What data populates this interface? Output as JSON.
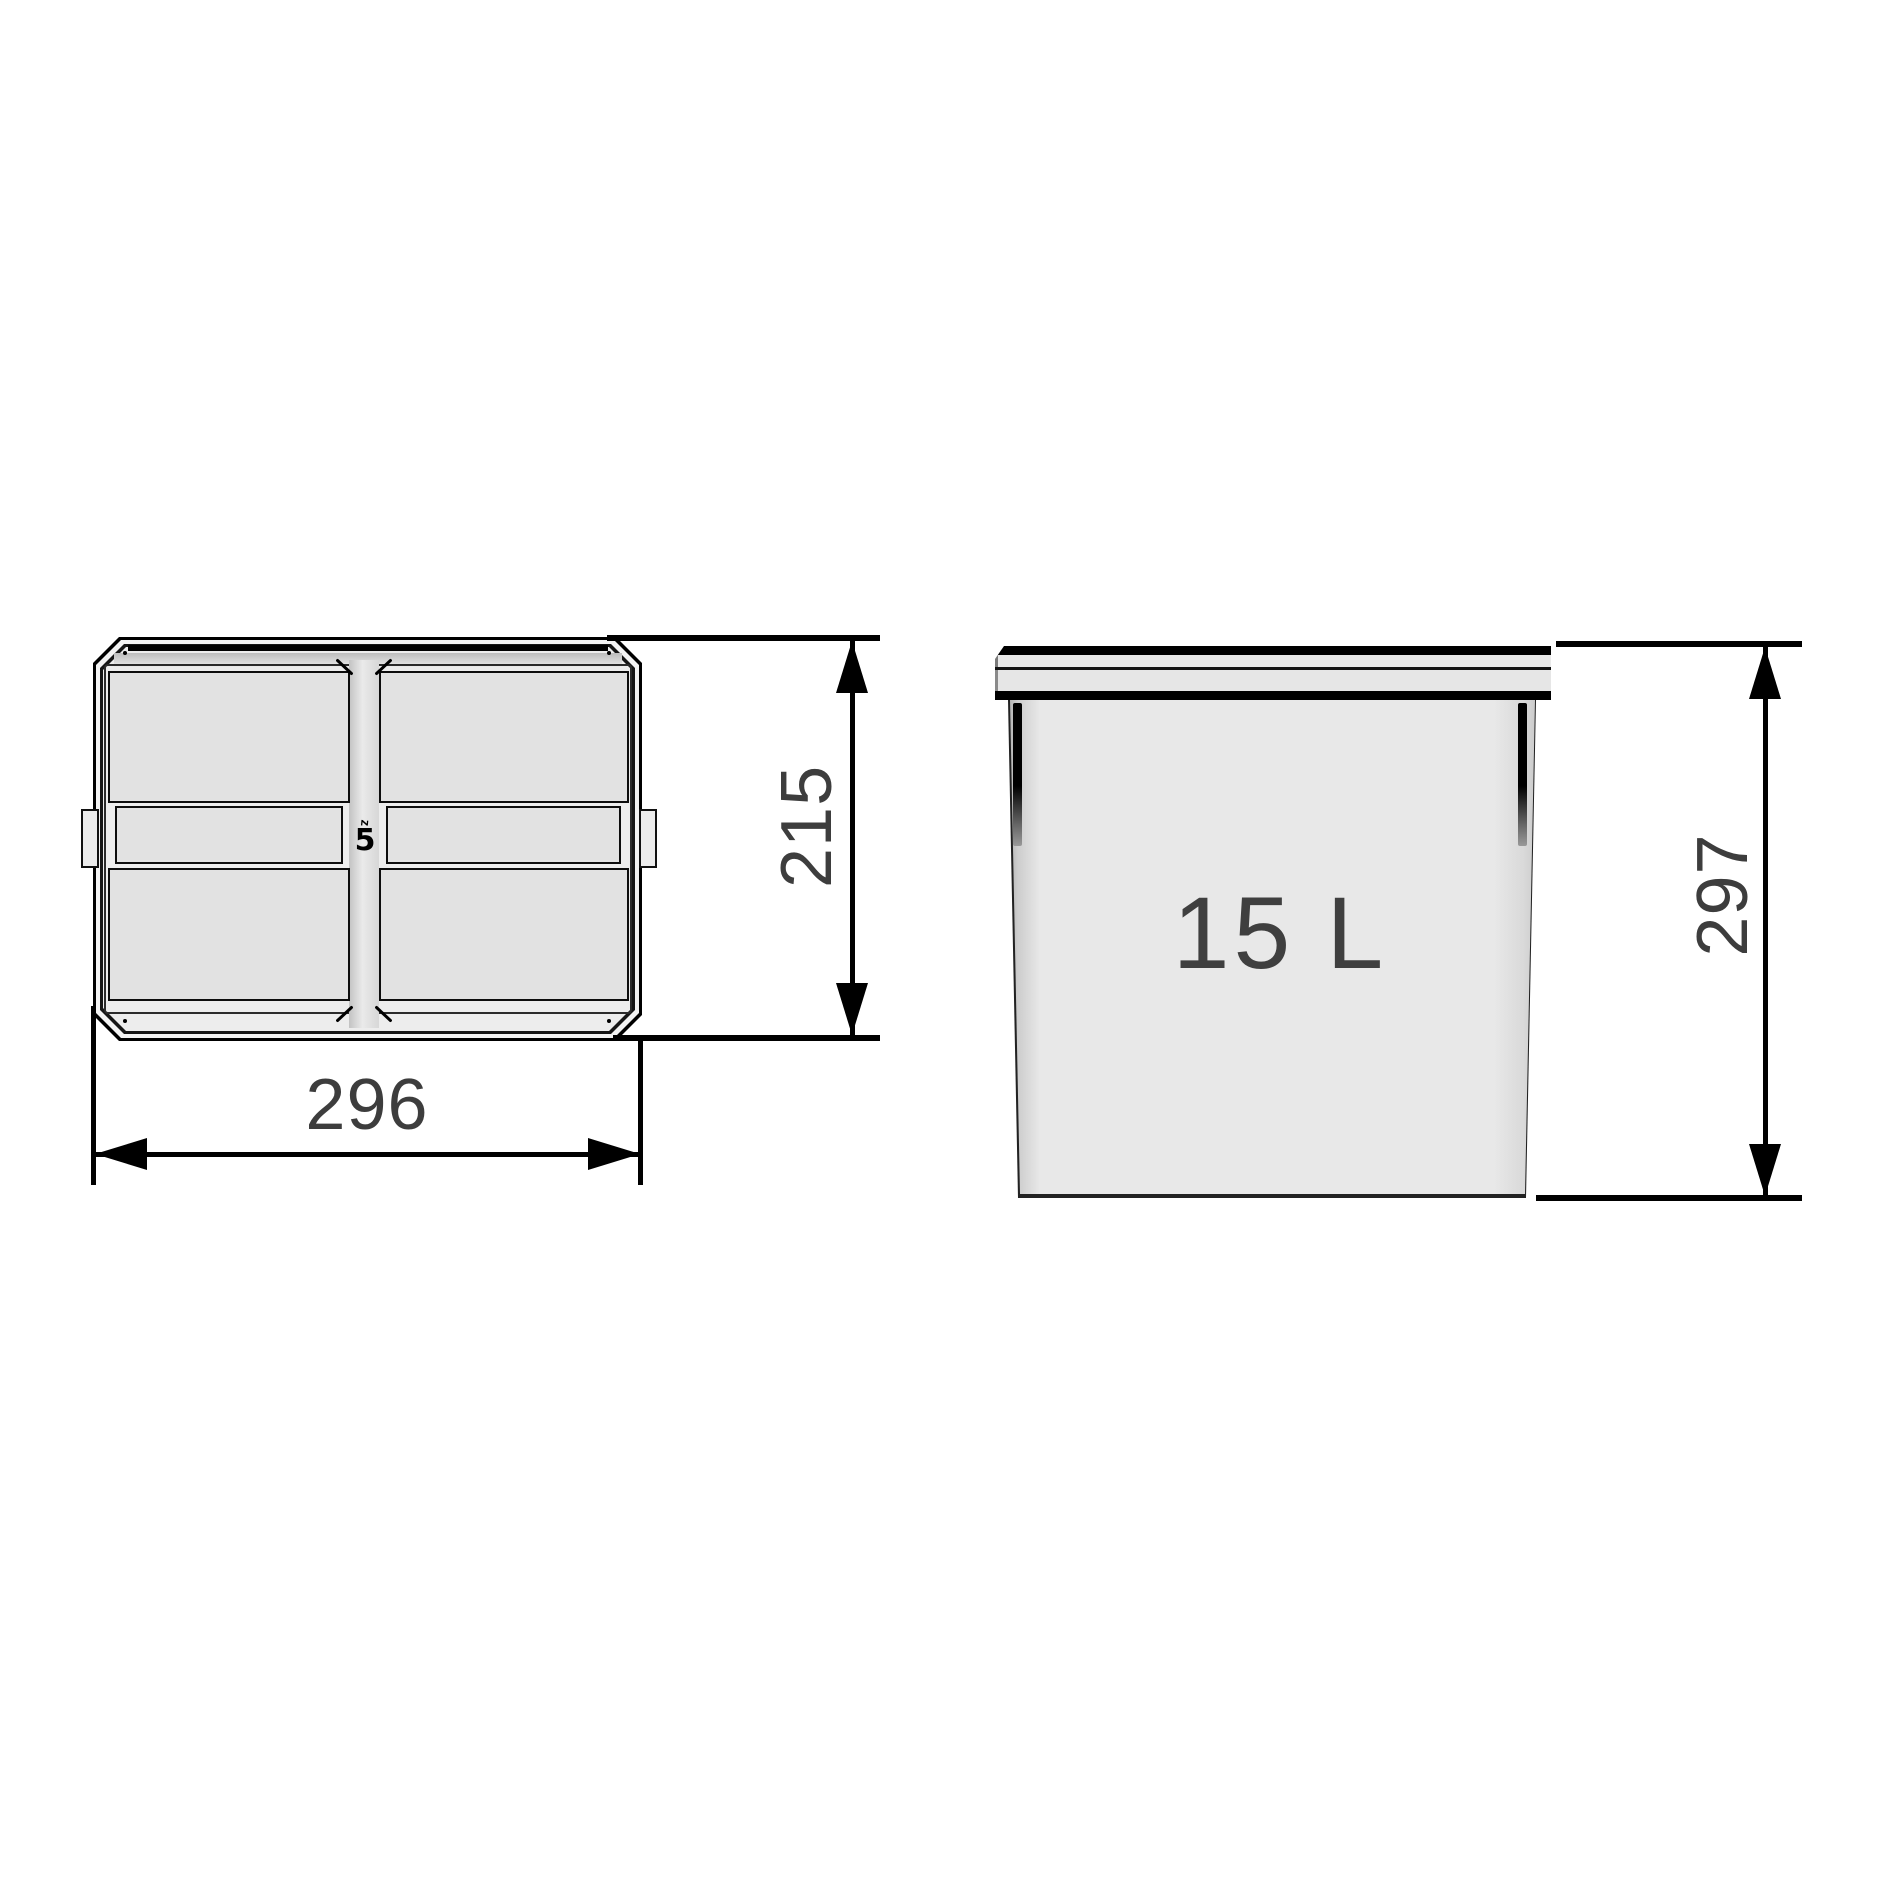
{
  "diagram": {
    "title_semantic": "waste-bin-dimension-drawing",
    "colors": {
      "background": "#ffffff",
      "line": "#000000",
      "dimension_text": "#3d3d3d",
      "fill_light": "#ededed",
      "fill_panel": "#e2e2e2"
    },
    "top_view": {
      "width_dim": "296",
      "depth_dim": "215",
      "mold_mark_top": "z",
      "mold_mark_number": "5"
    },
    "front_view": {
      "capacity_label": "15 L",
      "height_dim": "297"
    }
  }
}
